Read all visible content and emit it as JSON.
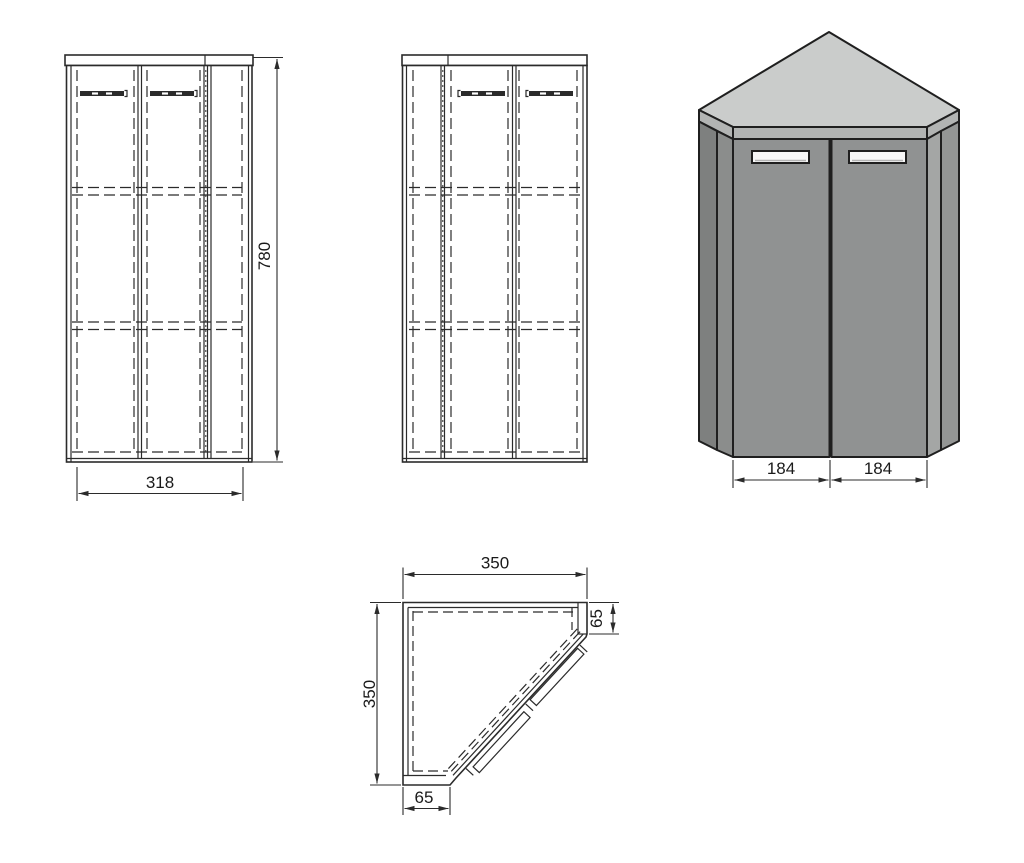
{
  "page": {
    "background": "#ffffff",
    "description_labels_visible": false
  },
  "colors": {
    "line": "#2b2b2b",
    "text": "#1a1a1a",
    "top-surface": "#cacccb",
    "top-band": "#b2b4b3",
    "door-face": "#909292",
    "left-side": "#7e807f",
    "left-bevel": "#8b8d8c",
    "right-bevel": "#a4a6a5",
    "right-side": "#949695",
    "handle-fill": "#f7f7f7",
    "handle-shade": "#b5b5b5"
  },
  "views": {
    "front_elevation": {
      "height_dim": "780",
      "width_dim": "318"
    },
    "mirrored_elevation": {},
    "perspective": {
      "left_door_dim": "184",
      "right_door_dim": "184"
    },
    "plan": {
      "width_dim": "350",
      "depth_dim": "350",
      "right_return_dim": "65",
      "bottom_return_dim": "65"
    }
  }
}
